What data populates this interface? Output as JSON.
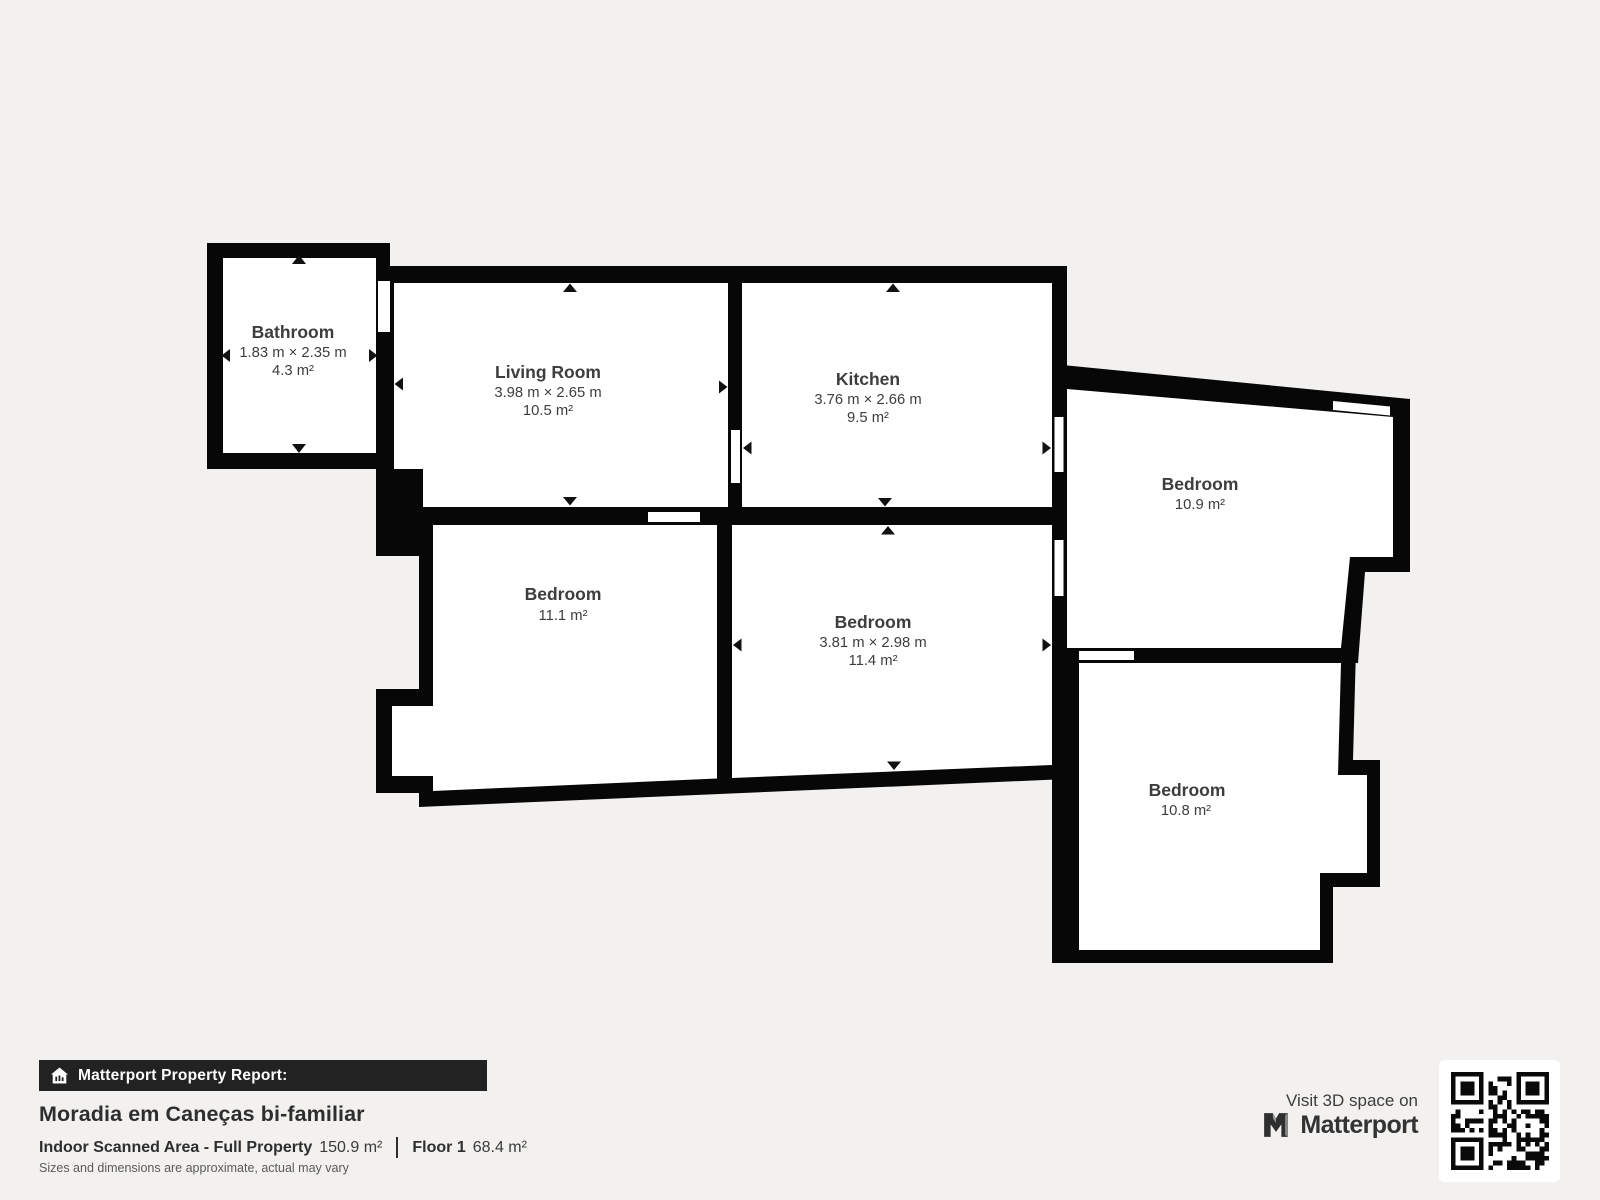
{
  "plan": {
    "rooms": [
      {
        "name": "Bathroom",
        "dims": "1.83 m × 2.35 m",
        "area": "4.3 m²"
      },
      {
        "name": "Living Room",
        "dims": "3.98 m × 2.65 m",
        "area": "10.5 m²"
      },
      {
        "name": "Kitchen",
        "dims": "3.76 m × 2.66 m",
        "area": "9.5 m²"
      },
      {
        "name": "Bedroom",
        "area": "10.9 m²"
      },
      {
        "name": "Bedroom",
        "area": "11.1 m²"
      },
      {
        "name": "Bedroom",
        "dims": "3.81 m × 2.98 m",
        "area": "11.4 m²"
      },
      {
        "name": "Bedroom",
        "area": "10.8 m²"
      }
    ]
  },
  "footer": {
    "report_label": "Matterport Property Report:",
    "property_title": "Moradia em Caneças bi-familiar",
    "area_label": "Indoor Scanned Area - Full Property",
    "area_value": "150.9 m²",
    "floor_label": "Floor 1",
    "floor_value": "68.4 m²",
    "disclaimer": "Sizes and dimensions are approximate, actual may vary",
    "visit_text": "Visit 3D space on",
    "brand": "Matterport"
  },
  "colors": {
    "background": "#f2f1ef",
    "wall": "#070707",
    "room": "#ffffff",
    "label": "#3d3d3d",
    "bar_bg": "#222222"
  }
}
